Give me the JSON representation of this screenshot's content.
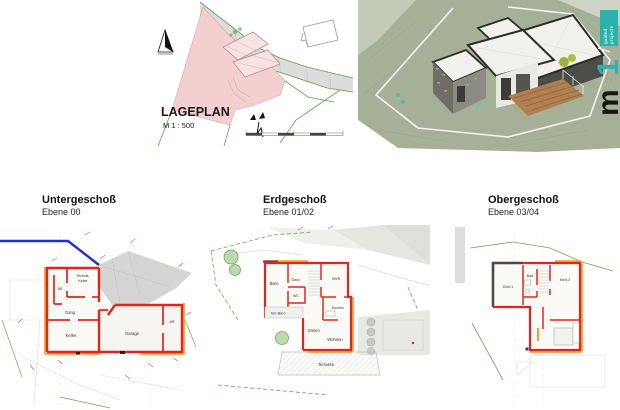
{
  "brand": {
    "badge_line1": "guided",
    "badge_line2": "projects",
    "logo_m": "m",
    "logo_1": "1"
  },
  "siteplan": {
    "title": "LAGEPLAN",
    "scale_label": "M 1 : 500"
  },
  "plans": [
    {
      "title": "Untergeschoß",
      "subtitle": "Ebene 00",
      "rooms": {
        "technik_line1": "Technik-",
        "technik_line2": "Keller",
        "ar_left": "AR",
        "gang": "Gang",
        "keller": "Keller",
        "garage": "Garage",
        "ar_right": "AR"
      }
    },
    {
      "title": "Erdgeschoß",
      "subtitle": "Ebene 01/02",
      "rooms": {
        "buero": "Büro",
        "gard": "Gard.",
        "wc": "WC",
        "hwr": "HWR",
        "kochen": "Kochen",
        "terr_buero": "Terr-Büro",
        "essen": "Essen",
        "wohnen": "Wohnen",
        "terrasse": "Terrasse"
      }
    },
    {
      "title": "Obergeschoß",
      "subtitle": "Ebene 03/04",
      "rooms": {
        "kind1": "Kind 1",
        "bad": "Bad",
        "kind2": "Kind 2"
      }
    }
  ],
  "colors": {
    "wall_red": "#e0261c",
    "accent_orange": "#f5921e",
    "boundary_blue": "#1f2fd4",
    "boundary_green": "#69a84f",
    "parcel_pink": "#f3cfd0",
    "teal": "#2ab3ab"
  }
}
